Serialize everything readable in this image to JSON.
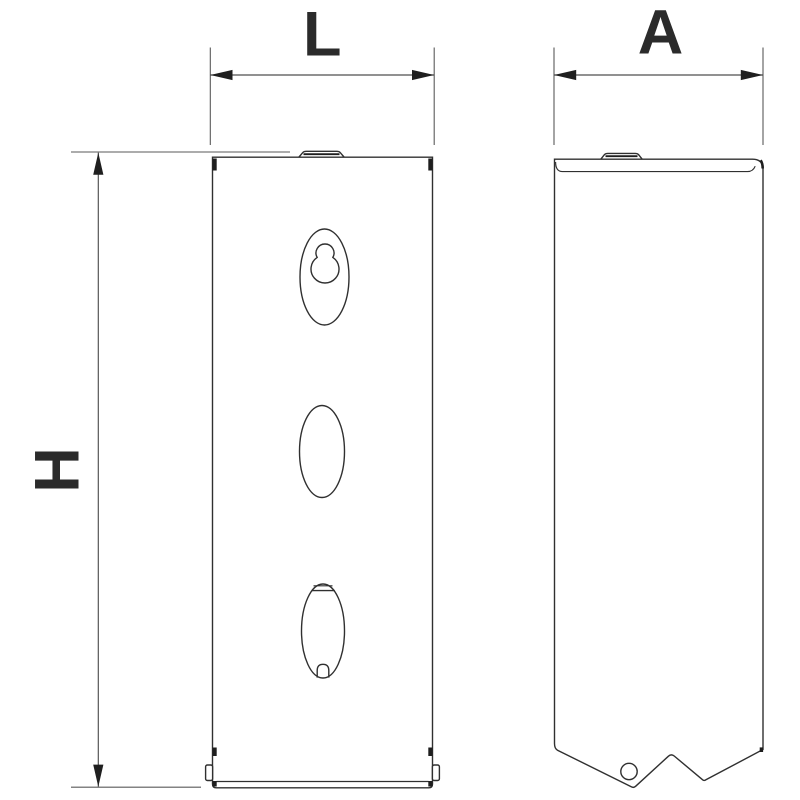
{
  "drawing": {
    "kind": "technical-dimension-drawing",
    "labels": {
      "length": "L",
      "depth": "A",
      "height": "H"
    },
    "colors": {
      "outline": "#303030",
      "dimension_line": "#4f4f4f",
      "label_text": "#2b2b2b",
      "background": "#ffffff"
    }
  }
}
